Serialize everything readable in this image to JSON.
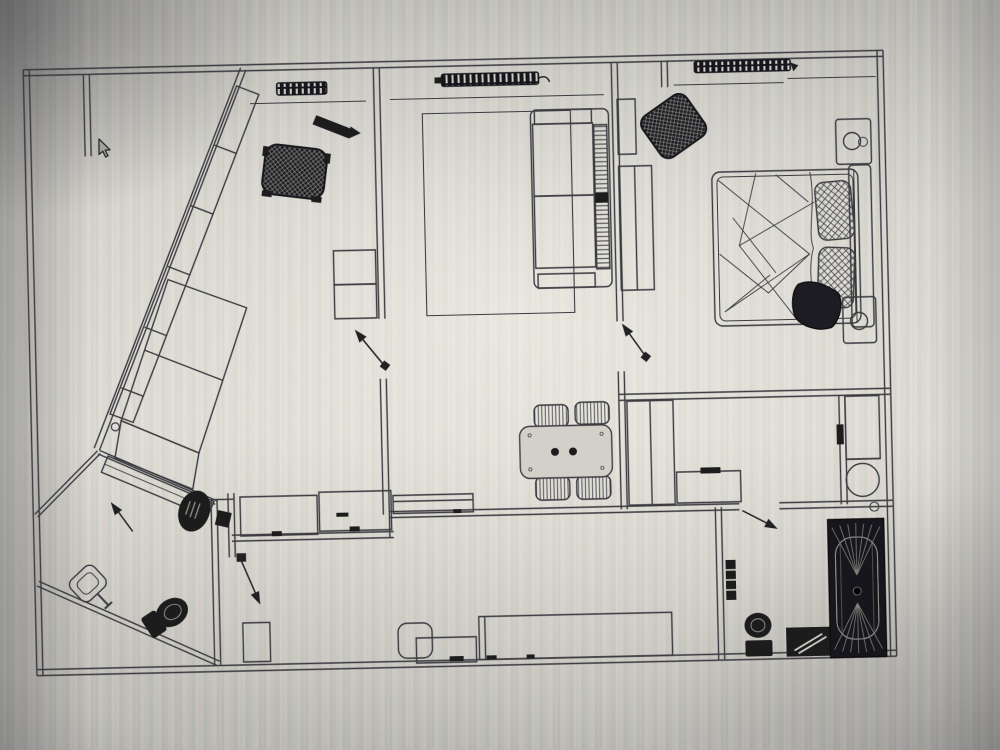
{
  "scene": {
    "description": "Photograph of a computer screen displaying a black-and-white CAD apartment floor plan",
    "visible_text": "none",
    "cursor": {
      "shape": "arrow-pointer",
      "x": 100,
      "y": 142
    }
  },
  "colors": {
    "line_ink": "#3a3b41",
    "dark_fill": "#1b1b1e",
    "screen_center": "#d7d4cd",
    "screen_edge": "#8f8e8b",
    "moire_green": "#a6c6a6",
    "moire_pink": "#c6aabc"
  },
  "floor_plan": {
    "door_swing_arrows": 5,
    "rooms": [
      {
        "name": "bedroom-top-left",
        "furniture": [
          "radiator",
          "wall-rack",
          "wicker-armchair",
          "shelf-unit",
          "angled-wardrobe",
          "angled-dresser",
          "diagonal-counter",
          "low-cabinets"
        ]
      },
      {
        "name": "living-room",
        "furniture": [
          "radiator",
          "rug",
          "sofa",
          "dining-table",
          "dining-chairs",
          "low-counter"
        ]
      },
      {
        "name": "bedroom-right",
        "furniture": [
          "radiator",
          "wardrobe",
          "wicker-armchair",
          "double-bed",
          "pillows",
          "blanket",
          "nightstands",
          "lamps"
        ]
      },
      {
        "name": "corridor-right",
        "furniture": [
          "closet",
          "cabinet"
        ]
      },
      {
        "name": "shower-room-right",
        "furniture": [
          "counter",
          "round-washbasin",
          "door-handle"
        ]
      },
      {
        "name": "bathroom-bottom",
        "furniture": [
          "bathtub",
          "toilet",
          "washing-machine",
          "towel-radiator"
        ]
      },
      {
        "name": "hallway-diagonal",
        "furniture": [
          "desk",
          "desk-chair",
          "storage-box"
        ]
      },
      {
        "name": "wc-bottom-left",
        "furniture": [
          "pedestal-washbasin",
          "toilet"
        ]
      },
      {
        "name": "entry-hall",
        "furniture": [
          "corner-cabinet",
          "pouf",
          "shoe-cabinet",
          "sideboard"
        ]
      }
    ]
  }
}
